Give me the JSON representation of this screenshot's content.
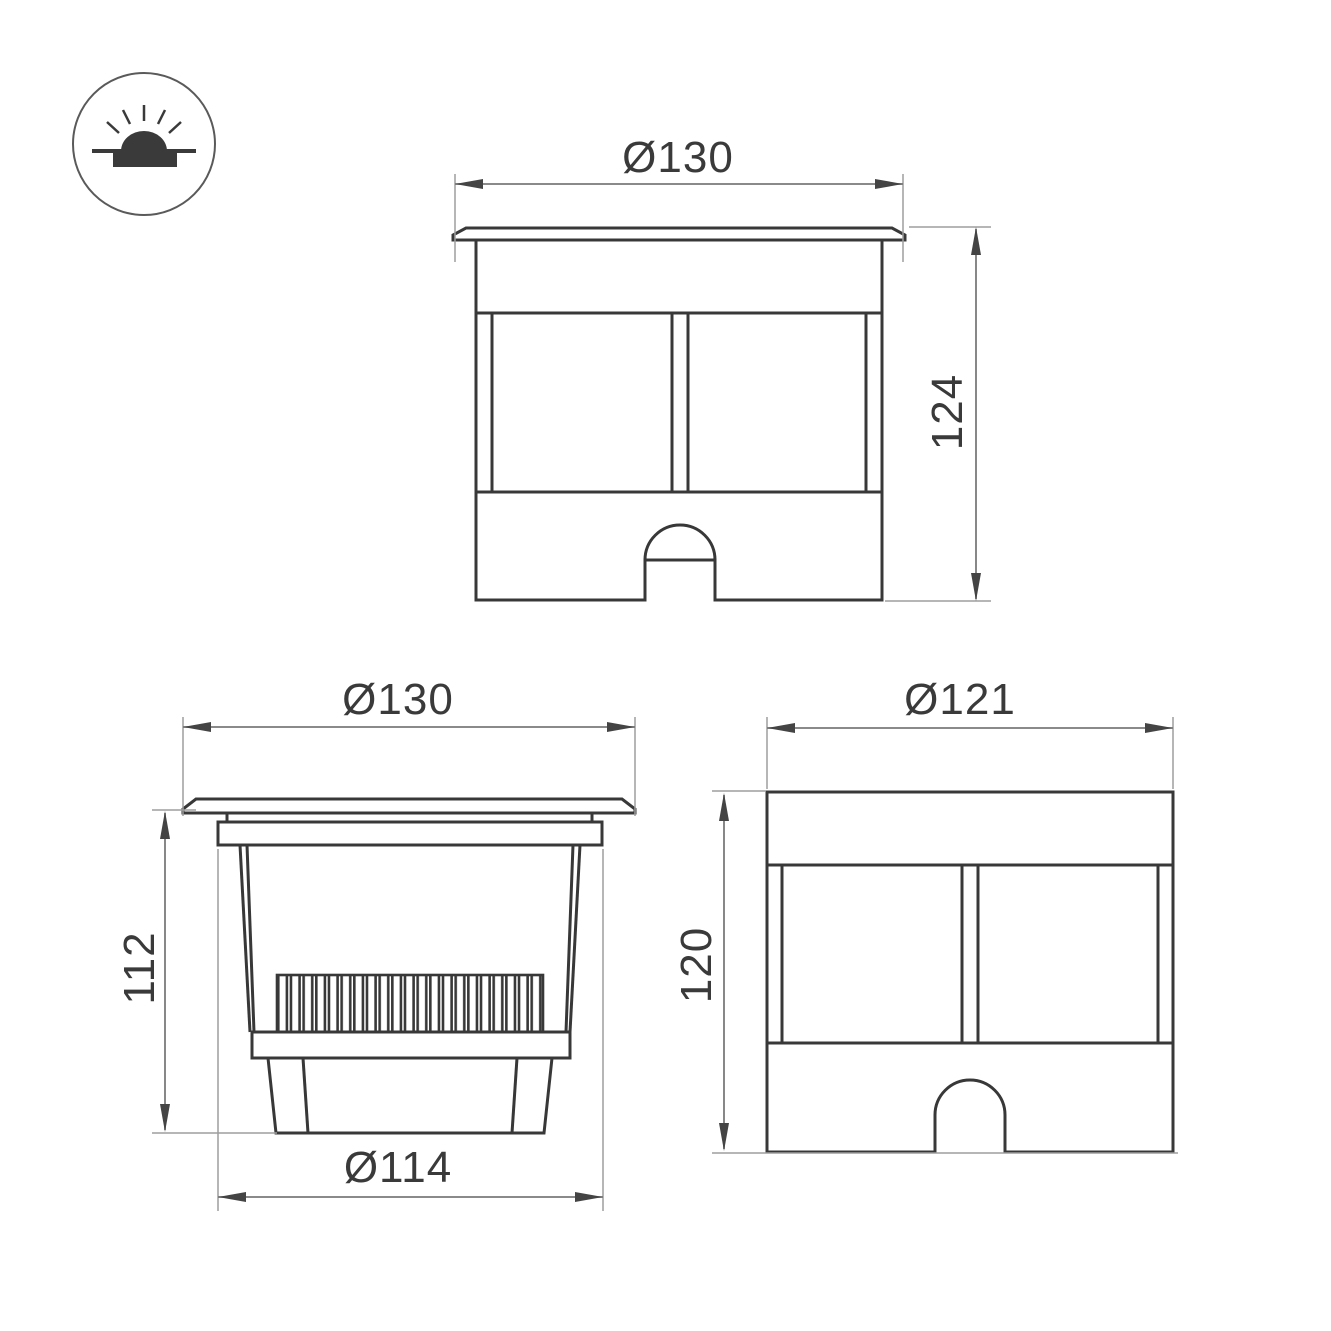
{
  "icon": {
    "symbol": "recessed-ground-light-icon"
  },
  "colors": {
    "background": "#ffffff",
    "object_line": "#383838",
    "dimension_line": "#7a7a7a",
    "extension_line": "#9e9e9e",
    "arrow": "#444444",
    "text": "#3a3a3a"
  },
  "views": {
    "front": {
      "dimensions": {
        "diameter": "Ø130",
        "height": "124"
      }
    },
    "section": {
      "dimensions": {
        "diameter": "Ø130",
        "height": "112",
        "body_diameter": "Ø114"
      }
    },
    "side": {
      "dimensions": {
        "diameter": "Ø121",
        "height": "120"
      }
    }
  }
}
